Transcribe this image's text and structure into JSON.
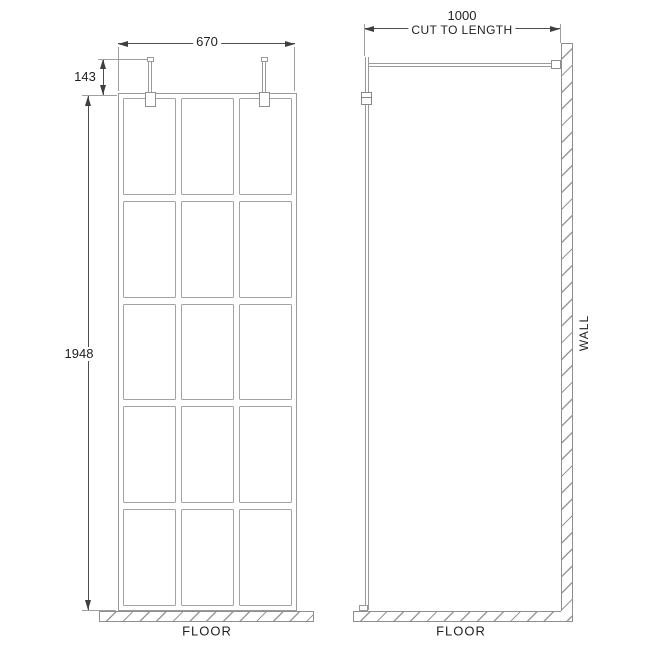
{
  "front_view": {
    "width_dim_label": "670",
    "bracket_height_dim_label": "143",
    "panel_height_dim_label": "1948",
    "floor_label": "FLOOR",
    "grid_columns": 3,
    "grid_rows": 5
  },
  "side_view": {
    "bar_dim_label": "1000",
    "bar_dim_note": "CUT TO LENGTH",
    "wall_label": "WALL",
    "floor_label": "FLOOR"
  },
  "colors": {
    "frame_line": "#9a9a9a",
    "dimension_line": "#4d4d4d",
    "hatch_line": "#9a9a9a",
    "text": "#1f1f1f",
    "background": "#ffffff"
  }
}
